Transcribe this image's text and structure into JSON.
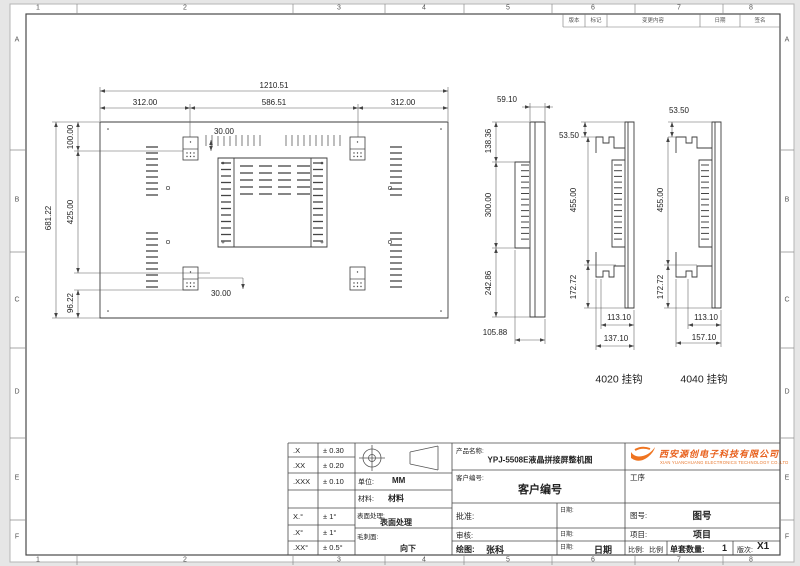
{
  "sheet": {
    "columns": [
      "1",
      "2",
      "3",
      "4",
      "5",
      "6",
      "7",
      "8"
    ],
    "rows": [
      "A",
      "B",
      "C",
      "D",
      "E",
      "F"
    ]
  },
  "revision": {
    "col_version": "版本",
    "col_mark": "标记",
    "col_change": "变更内容",
    "col_date": "日期",
    "col_sign": "签名"
  },
  "main_view": {
    "dim_total_width": "1210.51",
    "dim_left": "312.00",
    "dim_center": "586.51",
    "dim_right": "312.00",
    "dim_top_offset": "30.00",
    "dim_height_top": "100.00",
    "dim_height_mid": "425.00",
    "dim_height_bottom": "96.22",
    "dim_total_height": "681.22",
    "dim_bottom_offset": "30.00"
  },
  "side_view_std": {
    "dim_thickness": "59.10",
    "dim_top": "138.36",
    "dim_mid": "300.00",
    "dim_bottom": "242.86",
    "dim_depth": "105.88"
  },
  "side_view_4020": {
    "label": "4020 挂钩",
    "dim_top_offset": "53.50",
    "dim_mid": "455.00",
    "dim_bottom": "172.72",
    "dim_hook": "113.10",
    "dim_depth": "137.10"
  },
  "side_view_4040": {
    "label": "4040 挂钩",
    "dim_top_offset": "53.50",
    "dim_mid": "455.00",
    "dim_bottom": "172.72",
    "dim_hook": "113.10",
    "dim_depth": "157.10"
  },
  "title_block": {
    "tolerance_rows": [
      {
        "s": ".X",
        "v": "± 0.30"
      },
      {
        "s": ".XX",
        "v": "± 0.20"
      },
      {
        "s": ".XXX",
        "v": "± 0.10"
      },
      {
        "s": "X.°",
        "v": "± 1°"
      },
      {
        "s": ".X°",
        "v": "± 1°"
      },
      {
        "s": ".XX°",
        "v": "± 0.5°"
      }
    ],
    "unit_label": "单位:",
    "unit_value": "MM",
    "material_label": "材料:",
    "material_value": "材料",
    "surface_label": "表面处理:",
    "surface_value": "表面处理",
    "burr_label": "毛刺面:",
    "burr_value": "向下",
    "product_name_label": "产品名称:",
    "product_name": "YPJ-5508E液晶拼接屏整机图",
    "customer_label": "客户编号:",
    "customer_value": "客户编号",
    "approve_label": "批准:",
    "review_label": "审核:",
    "draw_label": "绘图:",
    "drawer": "张科",
    "date_label": "日期:",
    "date_value": "日期",
    "process_label": "工序",
    "drawing_no_label": "图号:",
    "drawing_no": "图号",
    "project_label": "项目:",
    "project": "项目",
    "scale_label": "比例:",
    "scale": "比例",
    "qty_label": "单套数量:",
    "qty": "1",
    "rev_label": "版次:",
    "rev": "X1",
    "company_cn": "西安源创电子科技有限公司",
    "company_en": "XIAN YUANCHUANG ELECTRONICS TECHNOLOGY CO.,LTD",
    "accent_orange": "#e8601c"
  }
}
